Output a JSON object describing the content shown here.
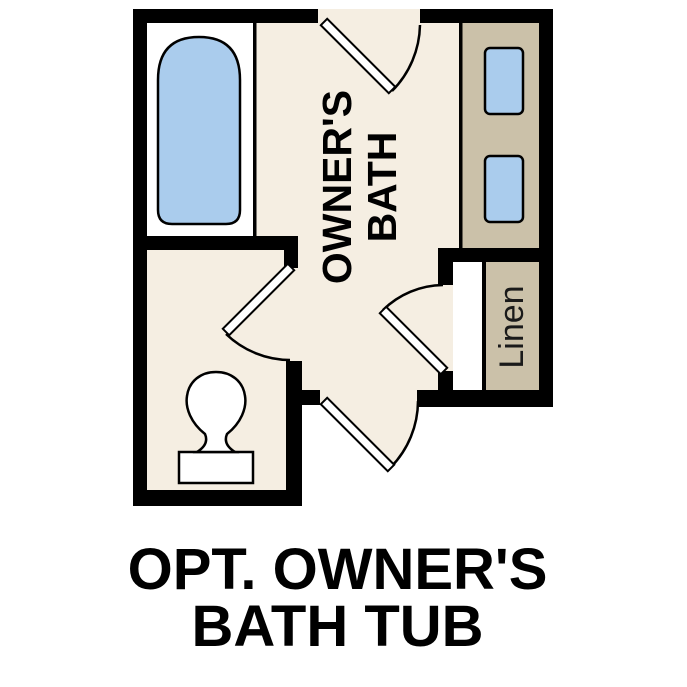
{
  "floorplan": {
    "room_label": {
      "line1": "OWNER'S",
      "line2": "BATH"
    },
    "linen_label": "Linen",
    "fixtures": {
      "bathtub": "bathtub",
      "toilet": "toilet",
      "sinks": [
        "vanity-sink-top",
        "vanity-sink-bottom"
      ],
      "doors": [
        "top-entry-door",
        "water-closet-door",
        "linen-closet-door",
        "bottom-entry-door"
      ]
    }
  },
  "caption": {
    "line1": "OPT. OWNER'S",
    "line2": "BATH TUB"
  },
  "colors": {
    "background": "#ffffff",
    "floor": "#f5eee2",
    "counter_tan": "#cbc1a9",
    "fixture_blue": "#aacced",
    "fixture_white": "#ffffff",
    "wall": "#000000"
  }
}
